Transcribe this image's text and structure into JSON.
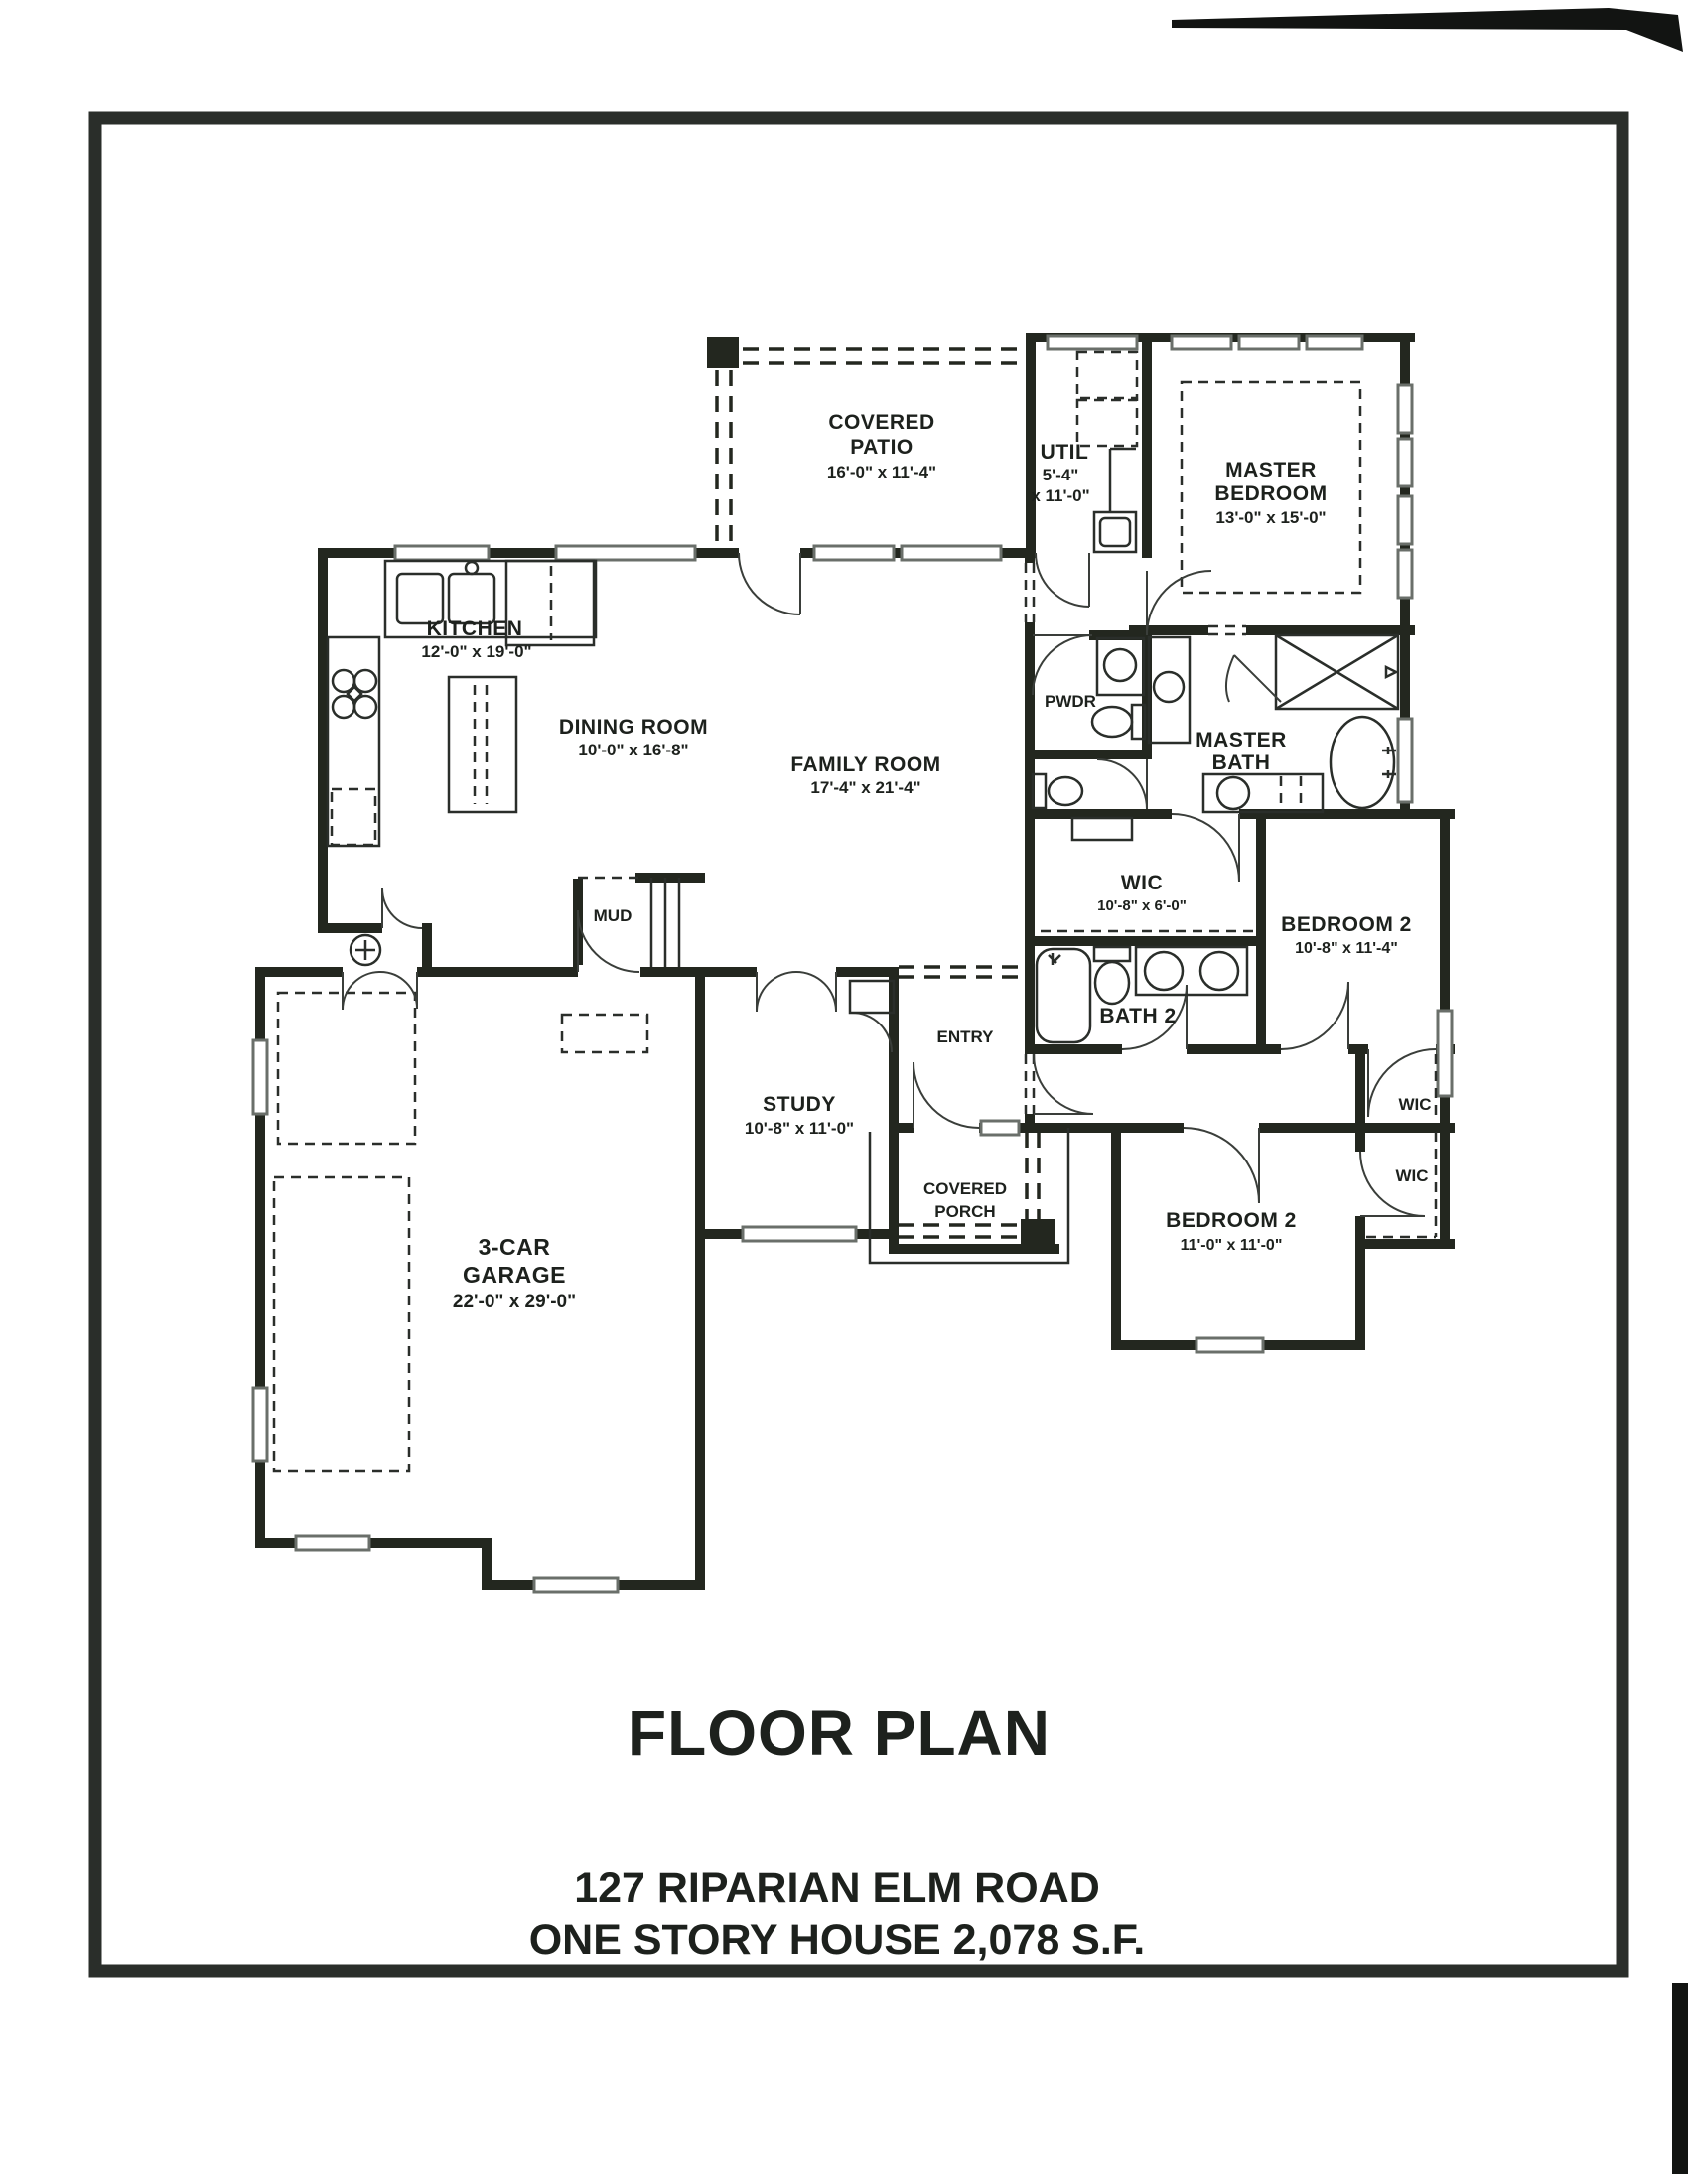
{
  "title_block": {
    "title": "FLOOR PLAN",
    "address_line1": "127 RIPARIAN ELM ROAD",
    "address_line2": "ONE STORY HOUSE 2,078 S.F."
  },
  "rooms": {
    "covered_patio": {
      "line1": "COVERED",
      "line2": "PATIO",
      "dims": "16'-0\" x 11'-4\""
    },
    "util": {
      "line1": "UTIL",
      "dims1": "5'-4\"",
      "dims2": "x 11'-0\""
    },
    "master_bedroom": {
      "line1": "MASTER",
      "line2": "BEDROOM",
      "dims": "13'-0\" x 15'-0\""
    },
    "kitchen": {
      "line1": "KITCHEN",
      "dims": "12'-0\" x 19'-0\""
    },
    "dining_room": {
      "line1": "DINING ROOM",
      "dims": "10'-0\" x 16'-8\""
    },
    "family_room": {
      "line1": "FAMILY ROOM",
      "dims": "17'-4\" x 21'-4\""
    },
    "pwdr": {
      "line1": "PWDR"
    },
    "master_bath": {
      "line1": "MASTER",
      "line2": "BATH"
    },
    "wic_master": {
      "line1": "WIC",
      "dims": "10'-8\" x 6'-0\""
    },
    "bedroom2_upper": {
      "line1": "BEDROOM 2",
      "dims": "10'-8\" x 11'-4\""
    },
    "mud": {
      "line1": "MUD"
    },
    "entry": {
      "line1": "ENTRY"
    },
    "study": {
      "line1": "STUDY",
      "dims": "10'-8\" x 11'-0\""
    },
    "bath2": {
      "line1": "BATH 2"
    },
    "wic_upper": {
      "line1": "WIC"
    },
    "wic_lower": {
      "line1": "WIC"
    },
    "covered_porch": {
      "line1": "COVERED",
      "line2": "PORCH"
    },
    "bedroom2_lower": {
      "line1": "BEDROOM 2",
      "dims": "11'-0\" x 11'-0\""
    },
    "garage": {
      "line1": "3-CAR",
      "line2": "GARAGE",
      "dims": "22'-0\" x 29'-0\""
    }
  },
  "colors": {
    "wall": "#23271f",
    "text": "#1d211d",
    "frame": "#2a2e2a",
    "paper": "#ffffff",
    "window_sill": "#6a6f6a"
  }
}
